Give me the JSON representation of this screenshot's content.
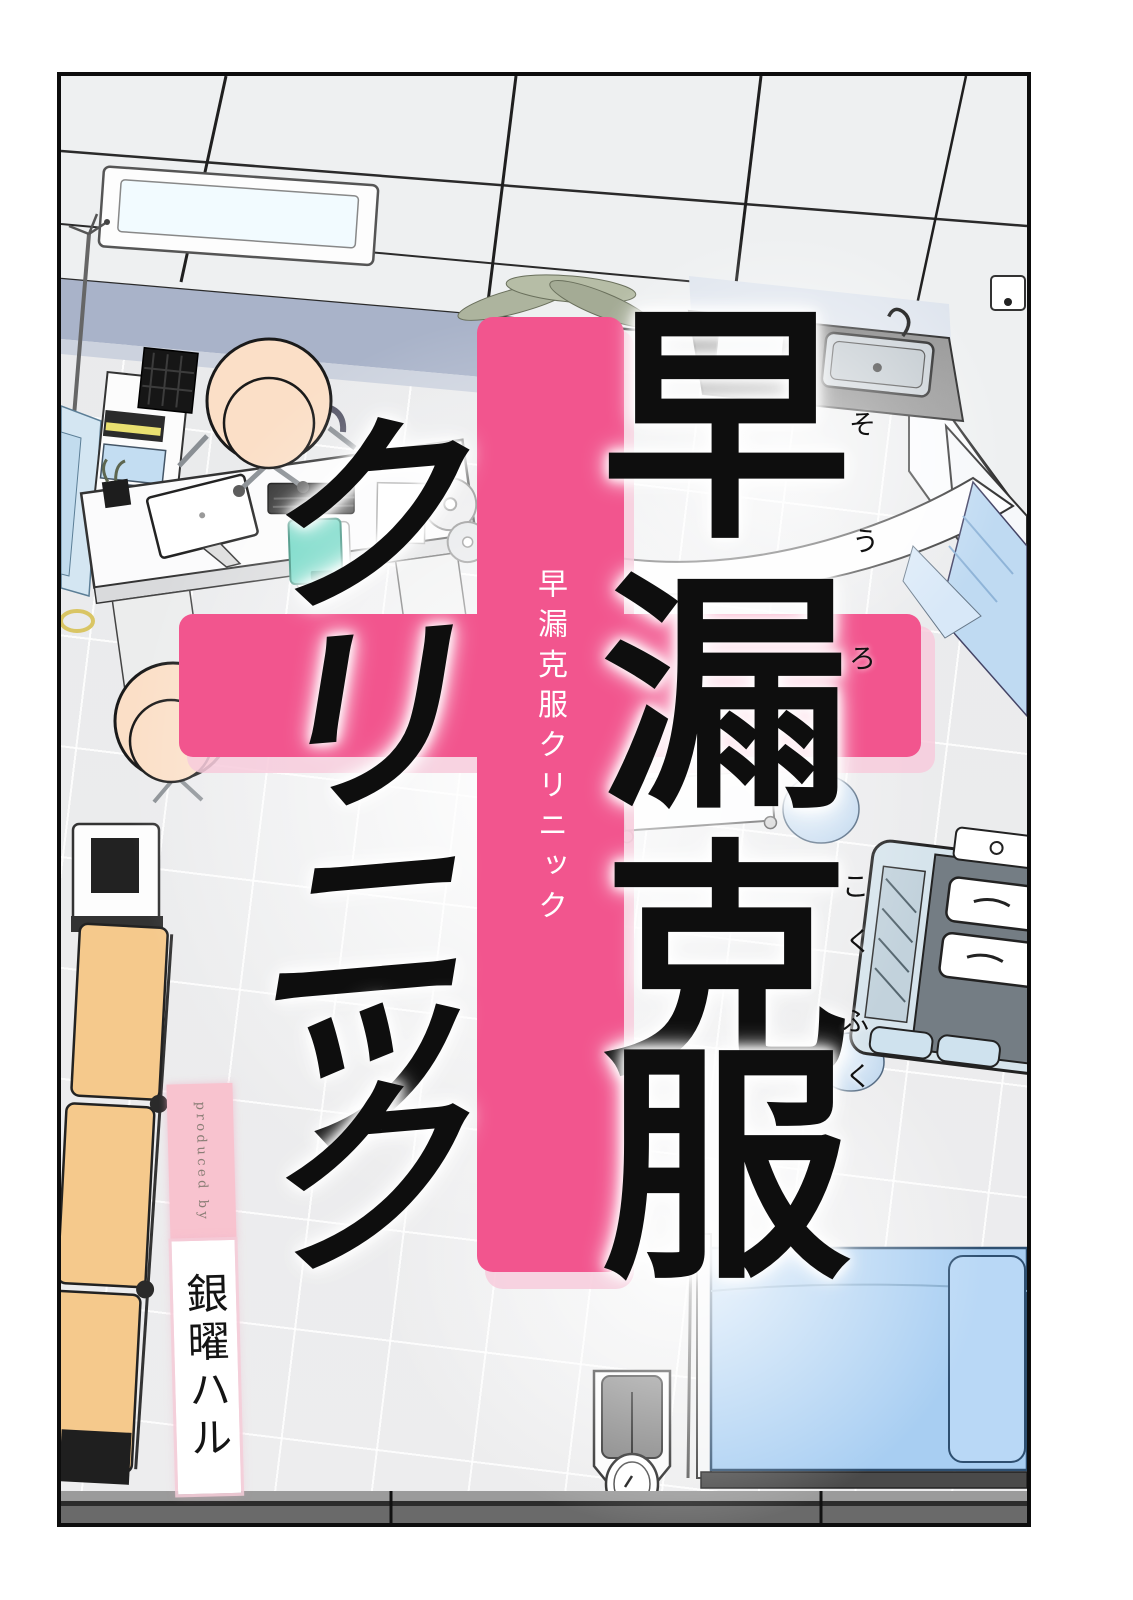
{
  "page": {
    "kind": "manga-title-page",
    "frame_color": "#0d0d0d",
    "margin_color": "#ffffff"
  },
  "title": {
    "main_column_chars": [
      "早",
      "漏",
      "克",
      "服"
    ],
    "kana_column_chars": [
      "ク",
      "リ",
      "ニ",
      "ッ",
      "ク"
    ],
    "furigana_sourou": [
      "そ",
      "う",
      "ろ"
    ],
    "furigana_kokufuku": [
      "こ",
      "く",
      "ふ",
      "く"
    ],
    "subtitle_on_cross": "早漏克服クリニック",
    "ink_color": "#0e0e0e",
    "subtitle_color": "#ffffff"
  },
  "cross": {
    "color": "#f2558e",
    "halo_color": "#f7cbdc"
  },
  "credits": {
    "produced_by": "produced by",
    "author": "銀曜ハル",
    "produced_by_bg": "#f8c3cf",
    "produced_by_text_color": "#8a7e76",
    "author_bg": "#ffffff",
    "author_text_color": "#141414"
  },
  "scene": {
    "setting": "clinic-room-top-view",
    "colors": {
      "floor": "#ecedee",
      "ceiling": "#eef0f1",
      "wall_band": "#a9b3c9",
      "office_chair": "#fbdfc7",
      "waiting_bench": "#f5c98c",
      "hospital_bed": "#a8cef2",
      "curtain": "#bfdaf2",
      "sink_counter": "#4f4f4f",
      "clipboard": "#66d5c1",
      "instrument_cart": "#d6e4ec"
    },
    "objects": [
      "ceiling-grid",
      "ceiling-light",
      "coat-rack",
      "hanging-gowns",
      "storage-shelf",
      "reception-desk",
      "desktop-monitor",
      "keyboard",
      "teal-clipboard",
      "office-chair",
      "patient-chair",
      "potted-plant",
      "sink-counter",
      "wall-cabinets",
      "curtain-rail",
      "curtain",
      "treatment-cart",
      "round-stool",
      "round-stool-2",
      "instrument-cart",
      "waiting-bench",
      "floor-machine",
      "hospital-bed",
      "pillow",
      "iv-pole",
      "weighing-scale",
      "baseboard"
    ]
  }
}
